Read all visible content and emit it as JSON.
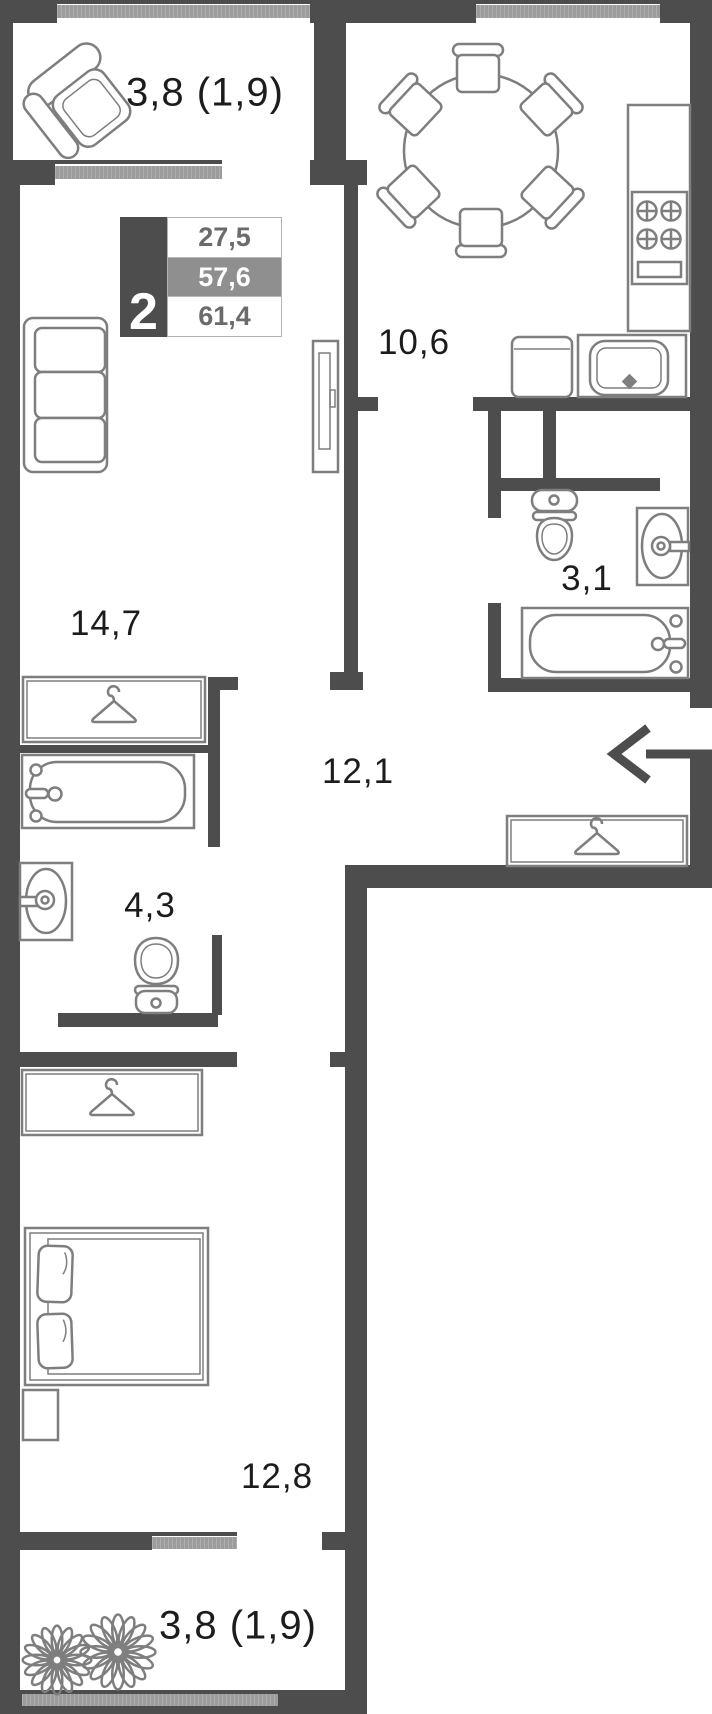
{
  "floorplan": {
    "badge": {
      "rooms_count": "2",
      "areas": [
        "27,5",
        "57,6",
        "61,4"
      ]
    },
    "labels": {
      "balcony_top": "3,8 (1,9)",
      "kitchen": "10,6",
      "living_room": "14,7",
      "bathroom_small": "3,1",
      "hallway": "12,1",
      "bathroom_large": "4,3",
      "bedroom": "12,8",
      "balcony_bottom": "3,8 (1,9)"
    },
    "icons": {
      "entry_arrow": "arrow-left",
      "wardrobe": "clothes-hanger",
      "plants": "flower"
    },
    "colors": {
      "wall": "#4d4d4d",
      "window": "#9c9c9c",
      "furniture": "#7e7e7e",
      "text": "#1c1c1c",
      "badge_highlight": "#8f8f8f",
      "badge_number": "#6b6b6b"
    }
  }
}
